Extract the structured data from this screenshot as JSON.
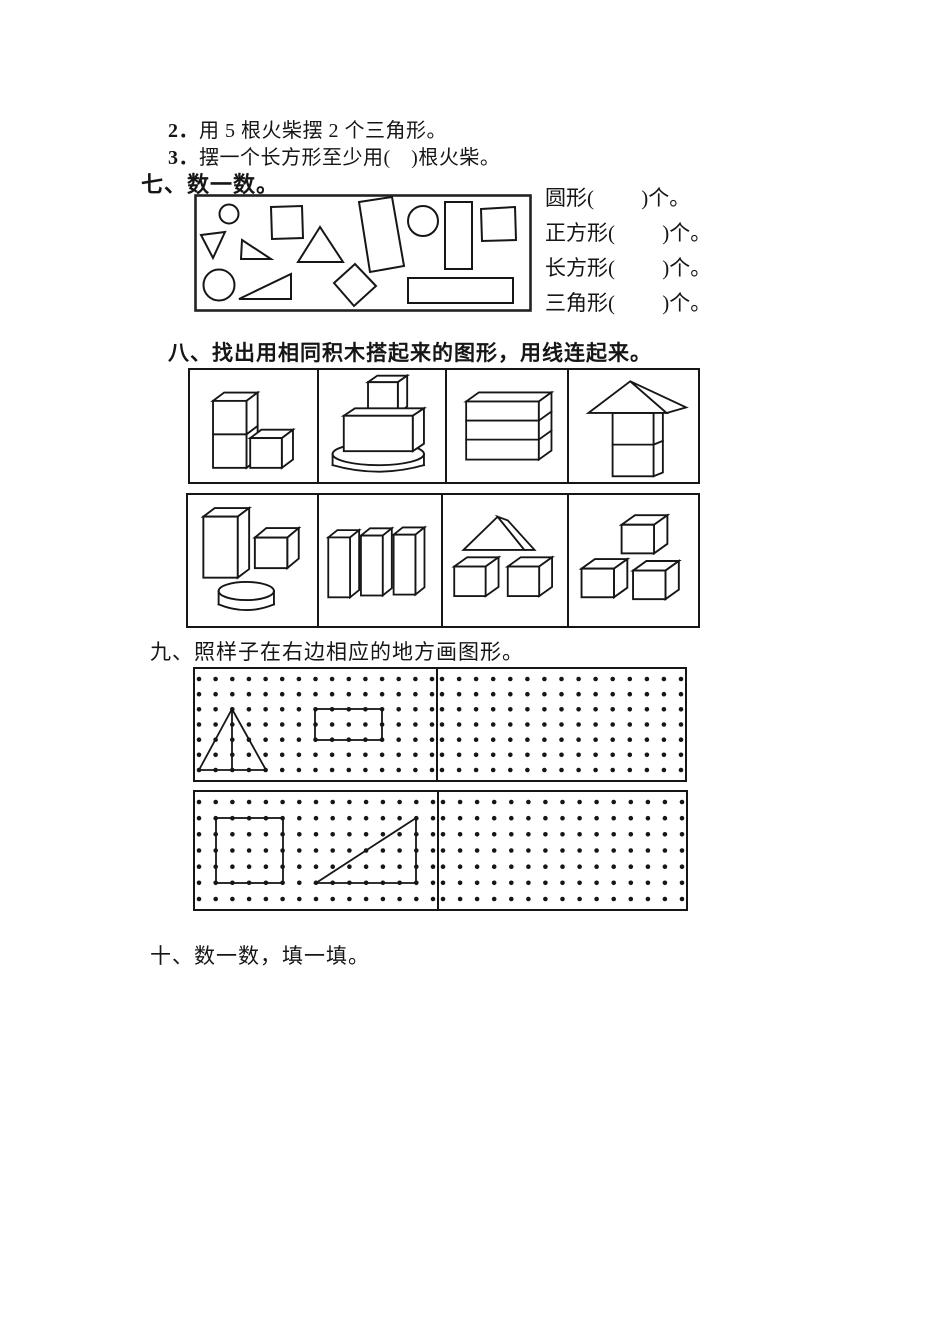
{
  "colors": {
    "ink": "#161616",
    "paper": "#ffffff"
  },
  "worksheet": {
    "intro_items": [
      {
        "num": "2．",
        "text": "用 5 根火柴摆 2 个三角形。"
      },
      {
        "num": "3．",
        "text": "摆一个长方形至少用(　)根火柴。"
      }
    ],
    "section7": {
      "heading": "七、数一数。",
      "shape_box_figures": [
        "circle",
        "tilted-square",
        "down-triangle",
        "small-right-triangle",
        "equilateral-triangle",
        "large-tilted-rectangle",
        "circle",
        "vertical-rectangle",
        "square",
        "circle",
        "large-right-triangle",
        "diamond-square",
        "horizontal-rectangle"
      ],
      "answer_lines": [
        "圆形(　　 )个。",
        "正方形(　　 )个。",
        "长方形(　　 )个。",
        "三角形(　　 )个。"
      ]
    },
    "section8": {
      "heading": "八、找出用相同积木搭起来的图形，用线连起来。",
      "row1_figures": [
        "three-cubes-l-shape",
        "cylinder-cuboid-cube-tower",
        "three-stacked-slabs",
        "house-roof-on-two-blocks"
      ],
      "row2_figures": [
        "tall-cuboid-cube-cylinder",
        "three-tall-cuboids",
        "triangular-prism-two-cubes",
        "three-cubes-pyramid"
      ]
    },
    "section9": {
      "heading": "九、照样子在右边相应的地方画图形。",
      "grids": {
        "rows": 7,
        "cols": 15,
        "panels": [
          {
            "name": "top-left",
            "examples": [
              "triangle-with-altitude",
              "rectangle"
            ]
          },
          {
            "name": "top-right",
            "examples": []
          },
          {
            "name": "bottom-left",
            "examples": [
              "square",
              "right-triangle"
            ]
          },
          {
            "name": "bottom-right",
            "examples": []
          }
        ]
      }
    },
    "section10": {
      "heading": "十、数一数，填一填。"
    }
  }
}
